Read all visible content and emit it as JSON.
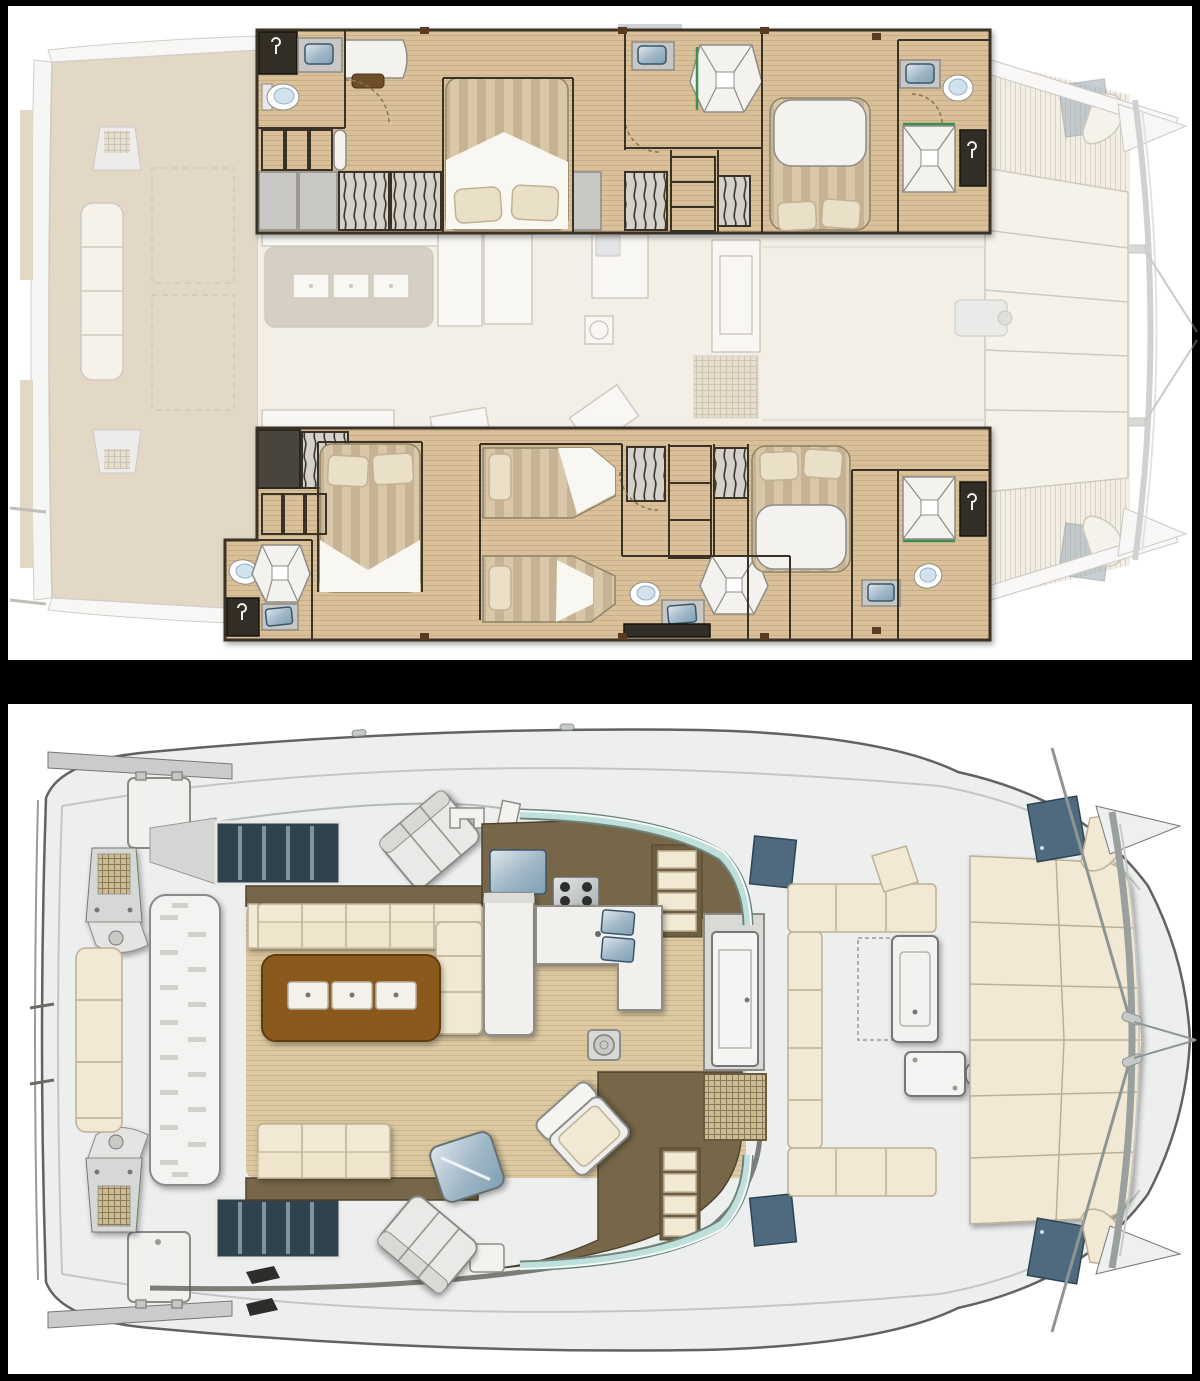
{
  "palette": {
    "bg": "#000000",
    "panel": "#ffffff",
    "ghost_wood": "#cbb492",
    "ghost_floor": "#e9e1d1",
    "ghost_cream": "#efe8d6",
    "ghost_taupe": "#b2a48d",
    "ghost_white": "#f4f1ea",
    "ghost_line": "#a49a88",
    "wall_dark": "#3a3128",
    "wood_floor": "#d9c099",
    "wood_corridor": "#cdb285",
    "stripe_a": "#d8c7a9",
    "stripe_b": "#c7b294",
    "pillow": "#eadfc7",
    "sheet": "#f9f7f1",
    "furn_white": "#f3f2ee",
    "furn_grey": "#c9c7c3",
    "shadow_grey": "#8e8c88",
    "sink_blue": "#7fa9c6",
    "sink_deep": "#39576e",
    "shower_dark": "#332d26",
    "green_trim": "#3f8f4f",
    "deck_white": "#edefee",
    "hull_line": "#63625e",
    "gunwale": "#c3c6c4",
    "salon_wood": "#dcc9a2",
    "galley_brown": "#776748",
    "table_brown": "#8a5a1e",
    "cream": "#f2e9d4",
    "cream_line": "#bdb096",
    "slate": "#4f6a7e",
    "teal": "#bfe0da",
    "grid_tan": "#cdbb92",
    "grid_line": "#8a7a58"
  }
}
